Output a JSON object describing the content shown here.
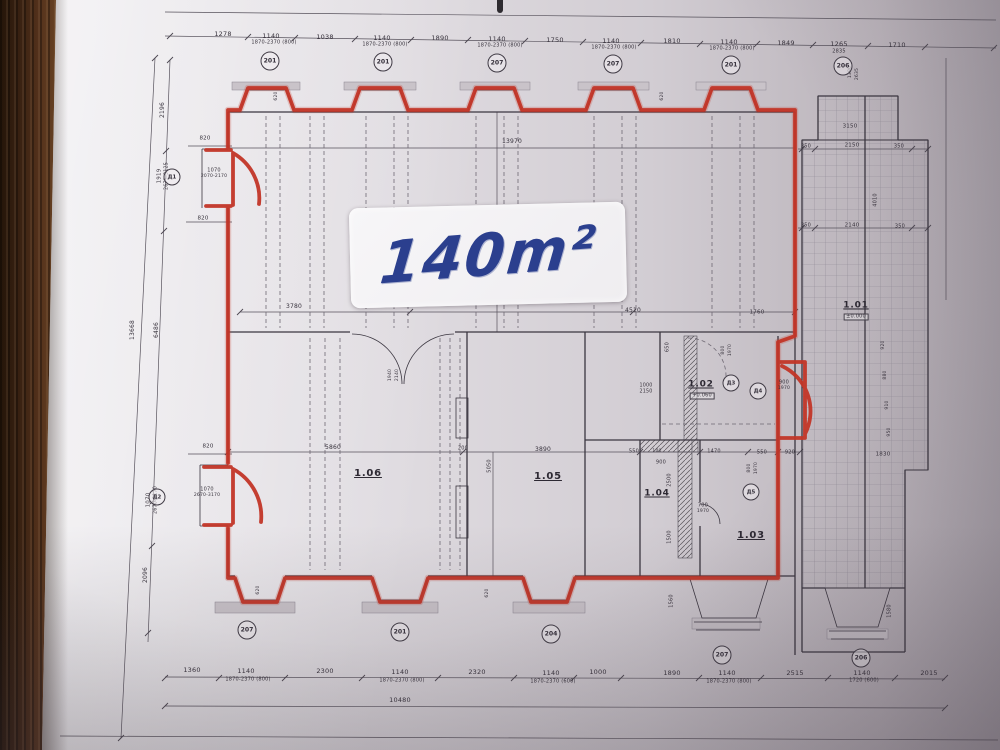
{
  "plan": {
    "type": "architectural floor plan photo",
    "area_label": "140m²",
    "outlined_area_color": "#c23527",
    "annotation_color": "#2b3f8e",
    "rooms": [
      "1.01",
      "1.02",
      "1.03",
      "1.04",
      "1.05",
      "1.06"
    ],
    "total_width_label": "10480",
    "interior_width_label": "13970"
  },
  "colors": {
    "marker_red": "#c23527",
    "marker_blue": "#2b3f8e",
    "paper": "#dcd8dd",
    "wood": "#5a3a22"
  },
  "texts": [
    {
      "t": "1278",
      "x": 223,
      "y": 34,
      "s": 6.5
    },
    {
      "t": "1140",
      "x": 271,
      "y": 36,
      "s": 6.5
    },
    {
      "t": "1870-2370 (800)",
      "x": 274,
      "y": 43,
      "s": 5
    },
    {
      "t": "1038",
      "x": 325,
      "y": 37,
      "s": 6.5
    },
    {
      "t": "1140",
      "x": 382,
      "y": 38,
      "s": 6.5
    },
    {
      "t": "1870-2370 (800)",
      "x": 385,
      "y": 45,
      "s": 5
    },
    {
      "t": "1890",
      "x": 440,
      "y": 38,
      "s": 6.5
    },
    {
      "t": "1140",
      "x": 497,
      "y": 39,
      "s": 6.5
    },
    {
      "t": "1870-2370 (800)",
      "x": 500,
      "y": 46,
      "s": 5
    },
    {
      "t": "1750",
      "x": 555,
      "y": 40,
      "s": 6.5
    },
    {
      "t": "1140",
      "x": 611,
      "y": 41,
      "s": 6.5
    },
    {
      "t": "1870-2370 (800)",
      "x": 614,
      "y": 48,
      "s": 5
    },
    {
      "t": "1810",
      "x": 672,
      "y": 41,
      "s": 6.5
    },
    {
      "t": "1140",
      "x": 729,
      "y": 42,
      "s": 6.5
    },
    {
      "t": "1870-2370 (800)",
      "x": 732,
      "y": 49,
      "s": 5
    },
    {
      "t": "1849",
      "x": 786,
      "y": 43,
      "s": 6.5
    },
    {
      "t": "1265",
      "x": 839,
      "y": 44,
      "s": 6.5
    },
    {
      "t": "2835",
      "x": 839,
      "y": 52,
      "s": 5
    },
    {
      "t": "1710",
      "x": 897,
      "y": 45,
      "s": 6.5
    },
    {
      "t": "1360",
      "x": 192,
      "y": 670,
      "s": 6.5
    },
    {
      "t": "1140",
      "x": 246,
      "y": 671,
      "s": 6.5
    },
    {
      "t": "1870-2370 (800)",
      "x": 248,
      "y": 680,
      "s": 5
    },
    {
      "t": "2300",
      "x": 325,
      "y": 671,
      "s": 6.5
    },
    {
      "t": "1140",
      "x": 400,
      "y": 672,
      "s": 6.5
    },
    {
      "t": "1870-2370 (800)",
      "x": 402,
      "y": 681,
      "s": 5
    },
    {
      "t": "2320",
      "x": 477,
      "y": 672,
      "s": 6.5
    },
    {
      "t": "1140",
      "x": 551,
      "y": 673,
      "s": 6.5
    },
    {
      "t": "1870-2370 (600)",
      "x": 553,
      "y": 682,
      "s": 5
    },
    {
      "t": "1000",
      "x": 598,
      "y": 672,
      "s": 6.5
    },
    {
      "t": "1890",
      "x": 672,
      "y": 673,
      "s": 6.5
    },
    {
      "t": "1140",
      "x": 727,
      "y": 673,
      "s": 6.5
    },
    {
      "t": "1870-2370 (800)",
      "x": 729,
      "y": 682,
      "s": 5
    },
    {
      "t": "2515",
      "x": 795,
      "y": 673,
      "s": 6.5
    },
    {
      "t": "1140",
      "x": 862,
      "y": 673,
      "s": 6.5
    },
    {
      "t": "1720 (600)",
      "x": 864,
      "y": 681,
      "s": 5
    },
    {
      "t": "2015",
      "x": 929,
      "y": 673,
      "s": 6.5
    },
    {
      "t": "10480",
      "x": 400,
      "y": 700,
      "s": 6.5
    },
    {
      "t": "2196",
      "x": 163,
      "y": 110,
      "s": 6,
      "r": -90
    },
    {
      "t": "1919",
      "x": 160,
      "y": 176,
      "s": 5.5,
      "r": -90
    },
    {
      "t": "2675-3125",
      "x": 168,
      "y": 176,
      "s": 4.8,
      "r": -90
    },
    {
      "t": "13668",
      "x": 133,
      "y": 330,
      "s": 6,
      "r": -90
    },
    {
      "t": "6486",
      "x": 157,
      "y": 330,
      "s": 6,
      "r": -90
    },
    {
      "t": "1070",
      "x": 149,
      "y": 500,
      "s": 5.5,
      "r": -90
    },
    {
      "t": "2670-3170",
      "x": 157,
      "y": 500,
      "s": 4.8,
      "r": -90
    },
    {
      "t": "2096",
      "x": 146,
      "y": 575,
      "s": 6,
      "r": -90
    },
    {
      "t": "820",
      "x": 205,
      "y": 139,
      "s": 5.5
    },
    {
      "t": "1070",
      "x": 214,
      "y": 171,
      "s": 5
    },
    {
      "t": "2070-2170",
      "x": 214,
      "y": 177,
      "s": 4.5
    },
    {
      "t": "820",
      "x": 203,
      "y": 219,
      "s": 5.5
    },
    {
      "t": "820",
      "x": 208,
      "y": 447,
      "s": 5.5
    },
    {
      "t": "1070",
      "x": 207,
      "y": 490,
      "s": 5
    },
    {
      "t": "2670-3170",
      "x": 207,
      "y": 496,
      "s": 4.5
    },
    {
      "t": "13970",
      "x": 512,
      "y": 142,
      "s": 6
    },
    {
      "t": "3780",
      "x": 294,
      "y": 307,
      "s": 6
    },
    {
      "t": "4510",
      "x": 633,
      "y": 311,
      "s": 6
    },
    {
      "t": "1760",
      "x": 757,
      "y": 313,
      "s": 5.5
    },
    {
      "t": "650",
      "x": 668,
      "y": 347,
      "s": 5,
      "r": -90
    },
    {
      "t": "800",
      "x": 724,
      "y": 350,
      "s": 4.5,
      "r": -90
    },
    {
      "t": "1970",
      "x": 731,
      "y": 350,
      "s": 4.5,
      "r": -90
    },
    {
      "t": "1000",
      "x": 646,
      "y": 387,
      "s": 4.8
    },
    {
      "t": "2150",
      "x": 646,
      "y": 393,
      "s": 4.8
    },
    {
      "t": "900",
      "x": 784,
      "y": 383,
      "s": 5
    },
    {
      "t": "1970",
      "x": 784,
      "y": 389,
      "s": 4.5
    },
    {
      "t": "1940",
      "x": 391,
      "y": 375,
      "s": 4.5,
      "r": -90
    },
    {
      "t": "2140",
      "x": 398,
      "y": 375,
      "s": 4.5,
      "r": -90
    },
    {
      "t": "5860",
      "x": 333,
      "y": 448,
      "s": 6
    },
    {
      "t": "200",
      "x": 463,
      "y": 449,
      "s": 5
    },
    {
      "t": "3890",
      "x": 543,
      "y": 450,
      "s": 6
    },
    {
      "t": "5050",
      "x": 490,
      "y": 466,
      "s": 5,
      "r": -90
    },
    {
      "t": "550",
      "x": 634,
      "y": 452,
      "s": 5
    },
    {
      "t": "100",
      "x": 657,
      "y": 452,
      "s": 4.5
    },
    {
      "t": "1470",
      "x": 714,
      "y": 452,
      "s": 5
    },
    {
      "t": "550",
      "x": 762,
      "y": 453,
      "s": 5
    },
    {
      "t": "920",
      "x": 790,
      "y": 453,
      "s": 5
    },
    {
      "t": "900",
      "x": 661,
      "y": 463,
      "s": 5
    },
    {
      "t": "2500",
      "x": 670,
      "y": 480,
      "s": 5,
      "r": -90
    },
    {
      "t": "1500",
      "x": 670,
      "y": 537,
      "s": 5,
      "r": -90
    },
    {
      "t": "700",
      "x": 703,
      "y": 506,
      "s": 5
    },
    {
      "t": "1970",
      "x": 703,
      "y": 512,
      "s": 4.5
    },
    {
      "t": "800",
      "x": 750,
      "y": 468,
      "s": 4.5,
      "r": -90
    },
    {
      "t": "1970",
      "x": 757,
      "y": 468,
      "s": 4.5,
      "r": -90
    },
    {
      "n": "room-label-1-06",
      "t": "1.06",
      "x": 368,
      "y": 474,
      "s": 10,
      "cls": "room"
    },
    {
      "n": "room-label-1-05",
      "t": "1.05",
      "x": 548,
      "y": 477,
      "s": 10,
      "cls": "room"
    },
    {
      "n": "room-label-1-04",
      "t": "1.04",
      "x": 657,
      "y": 494,
      "s": 9,
      "cls": "room"
    },
    {
      "n": "room-label-1-03",
      "t": "1.03",
      "x": 751,
      "y": 536,
      "s": 10,
      "cls": "room"
    },
    {
      "n": "room-label-1-02",
      "t": "1.02",
      "x": 701,
      "y": 385,
      "s": 9,
      "cls": "room"
    },
    {
      "n": "elevation-1-02",
      "t": "+0.060",
      "x": 702,
      "y": 396,
      "s": 5,
      "cls": "box"
    },
    {
      "n": "room-label-1-01",
      "t": "1.01",
      "x": 856,
      "y": 306,
      "s": 9,
      "cls": "room"
    },
    {
      "n": "elevation-1-01",
      "t": "±0.000",
      "x": 856,
      "y": 317,
      "s": 5,
      "cls": "box"
    },
    {
      "t": "3150",
      "x": 850,
      "y": 127,
      "s": 5.5
    },
    {
      "t": "350",
      "x": 806,
      "y": 147,
      "s": 5
    },
    {
      "t": "2150",
      "x": 852,
      "y": 146,
      "s": 5.5
    },
    {
      "t": "350",
      "x": 899,
      "y": 147,
      "s": 5
    },
    {
      "t": "350",
      "x": 806,
      "y": 226,
      "s": 5
    },
    {
      "t": "2140",
      "x": 852,
      "y": 226,
      "s": 5.5
    },
    {
      "t": "350",
      "x": 900,
      "y": 227,
      "s": 5
    },
    {
      "t": "4010",
      "x": 876,
      "y": 200,
      "s": 5,
      "r": -90
    },
    {
      "t": "1830",
      "x": 883,
      "y": 455,
      "s": 5.5
    },
    {
      "t": "1380",
      "x": 851,
      "y": 72,
      "s": 4.5,
      "r": -90
    },
    {
      "t": "2635",
      "x": 858,
      "y": 74,
      "s": 4.5,
      "r": -90
    },
    {
      "t": "920",
      "x": 884,
      "y": 345,
      "s": 4.5,
      "r": -90
    },
    {
      "t": "880",
      "x": 886,
      "y": 375,
      "s": 4.5,
      "r": -90
    },
    {
      "t": "910",
      "x": 888,
      "y": 405,
      "s": 4.5,
      "r": -90
    },
    {
      "t": "950",
      "x": 890,
      "y": 432,
      "s": 4.5,
      "r": -90
    },
    {
      "t": "1560",
      "x": 672,
      "y": 601,
      "s": 5,
      "r": -90
    },
    {
      "t": "1580",
      "x": 890,
      "y": 611,
      "s": 5,
      "r": -90
    },
    {
      "t": "620",
      "x": 259,
      "y": 590,
      "s": 4.5,
      "r": -90
    },
    {
      "t": "620",
      "x": 488,
      "y": 593,
      "s": 4.5,
      "r": -90
    },
    {
      "t": "620",
      "x": 277,
      "y": 96,
      "s": 4.5,
      "r": -90
    },
    {
      "t": "620",
      "x": 663,
      "y": 96,
      "s": 4.5,
      "r": -90
    }
  ],
  "circles": [
    {
      "n": "axis-mark",
      "t": "201",
      "x": 270,
      "y": 61
    },
    {
      "n": "axis-mark",
      "t": "201",
      "x": 383,
      "y": 62
    },
    {
      "n": "axis-mark",
      "t": "207",
      "x": 497,
      "y": 63
    },
    {
      "n": "axis-mark",
      "t": "207",
      "x": 613,
      "y": 64
    },
    {
      "n": "axis-mark",
      "t": "201",
      "x": 731,
      "y": 65
    },
    {
      "n": "axis-mark",
      "t": "206",
      "x": 843,
      "y": 66
    },
    {
      "n": "axis-mark",
      "t": "207",
      "x": 247,
      "y": 630
    },
    {
      "n": "axis-mark",
      "t": "201",
      "x": 400,
      "y": 632
    },
    {
      "n": "axis-mark",
      "t": "204",
      "x": 551,
      "y": 634
    },
    {
      "n": "axis-mark",
      "t": "207",
      "x": 722,
      "y": 655
    },
    {
      "n": "axis-mark",
      "t": "206",
      "x": 861,
      "y": 658
    },
    {
      "n": "door-mark",
      "t": "Д1",
      "x": 172,
      "y": 177,
      "d": 15
    },
    {
      "n": "door-mark",
      "t": "Д2",
      "x": 157,
      "y": 497,
      "d": 15
    },
    {
      "n": "door-mark",
      "t": "Д3",
      "x": 731,
      "y": 383,
      "d": 15
    },
    {
      "n": "door-mark",
      "t": "Д4",
      "x": 758,
      "y": 391,
      "d": 15
    },
    {
      "n": "door-mark",
      "t": "Д5",
      "x": 751,
      "y": 492,
      "d": 15
    }
  ]
}
